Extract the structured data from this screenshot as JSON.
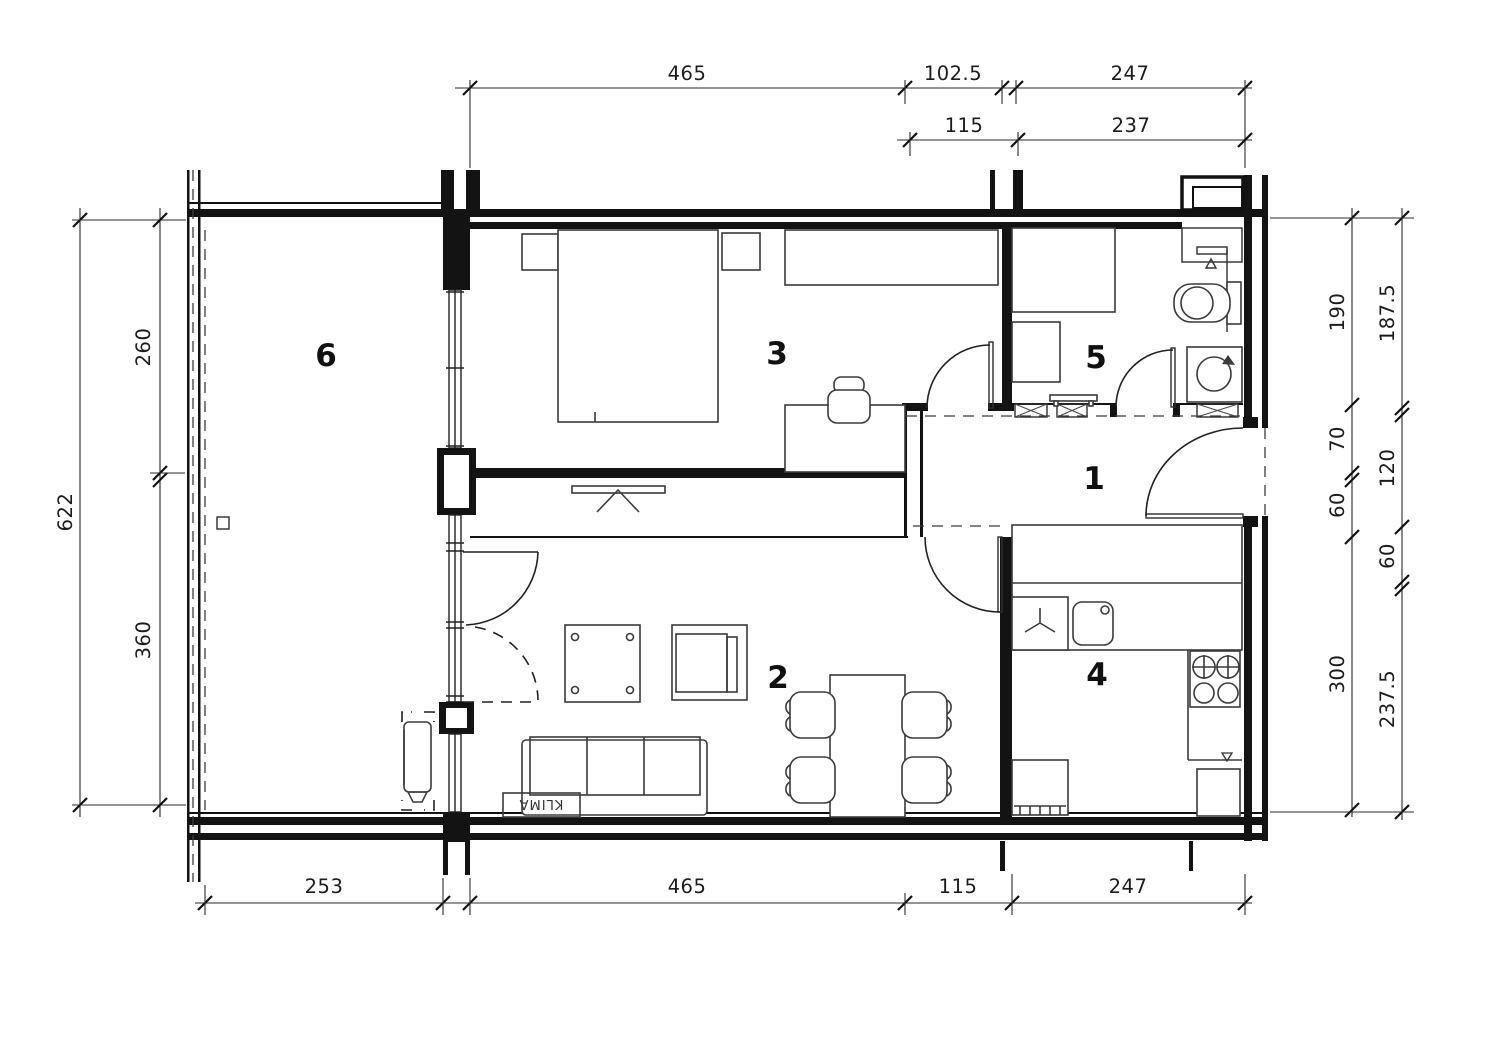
{
  "drawing": {
    "type": "apartment-floor-plan",
    "units": "cm",
    "rooms": [
      {
        "number": "1",
        "role": "hallway"
      },
      {
        "number": "2",
        "role": "living-room"
      },
      {
        "number": "3",
        "role": "bedroom"
      },
      {
        "number": "4",
        "role": "kitchen"
      },
      {
        "number": "5",
        "role": "bathroom"
      },
      {
        "number": "6",
        "role": "terrace"
      }
    ],
    "annotations": {
      "klima": "KLIMA"
    },
    "dimensions": {
      "top_row1": [
        "465",
        "102.5",
        "247"
      ],
      "top_row2": [
        "115",
        "237"
      ],
      "bottom": [
        "253",
        "465",
        "115",
        "247"
      ],
      "left_outer": [
        "622"
      ],
      "left_inner": [
        "260",
        "360"
      ],
      "right_inner": [
        "190",
        "70",
        "60",
        "300"
      ],
      "right_outer": [
        "187.5",
        "120",
        "60",
        "237.5"
      ]
    }
  }
}
